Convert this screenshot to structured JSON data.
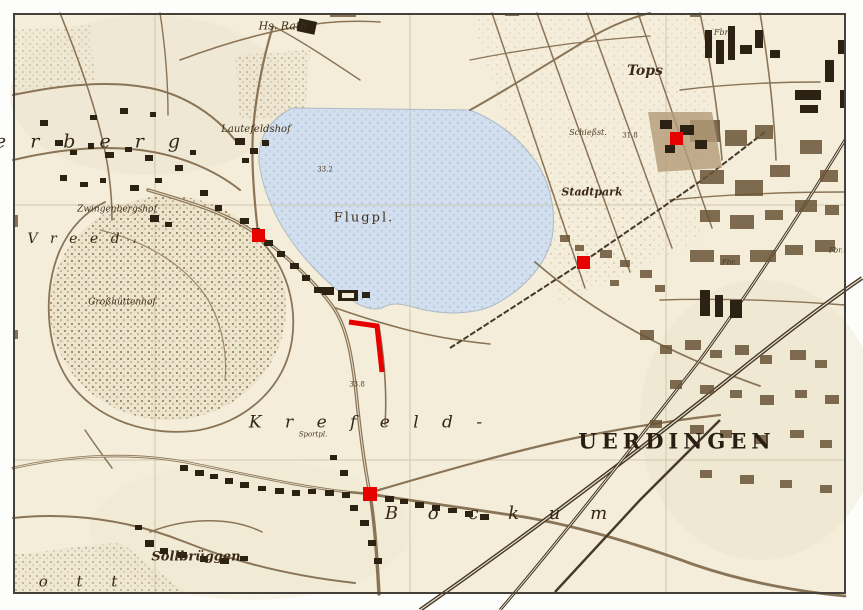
{
  "map": {
    "colors": {
      "paper": "#f3edda",
      "ink": "#3f2f1b",
      "building": "#2c2214",
      "road": "#8a7456",
      "rail": "#47392a",
      "water": "#d2dfee",
      "frame": "#45413a",
      "annotation_red": "#e60000"
    },
    "labels": [
      {
        "id": "hs-rath",
        "text": "Hs. Rath",
        "x": 283,
        "y": 26,
        "size": 11,
        "cls": "cursive"
      },
      {
        "id": "lautefeldshof",
        "text": "Lautefeldshof",
        "x": 256,
        "y": 130,
        "size": 10,
        "cls": "cursive"
      },
      {
        "id": "zwingenbergshof",
        "text": "Zwingenbergshof",
        "x": 117,
        "y": 210,
        "size": 9,
        "cls": "cursive"
      },
      {
        "id": "grosshuettenhof",
        "text": "Großhüttenhof",
        "x": 122,
        "y": 303,
        "size": 9,
        "cls": "cursive"
      },
      {
        "id": "flugplatz",
        "text": "Flugpl.",
        "x": 364,
        "y": 218,
        "size": 13,
        "cls": "serif-sp"
      },
      {
        "id": "height-33-2",
        "text": "33.2",
        "x": 325,
        "y": 170,
        "size": 7,
        "cls": "tiny"
      },
      {
        "id": "height-31-8",
        "text": "31.8",
        "x": 630,
        "y": 136,
        "size": 7,
        "cls": "tiny"
      },
      {
        "id": "height-33-8",
        "text": "33.8",
        "x": 357,
        "y": 385,
        "size": 7,
        "cls": "tiny"
      },
      {
        "id": "tops",
        "text": "Tops",
        "x": 645,
        "y": 71,
        "size": 14,
        "cls": "cursive-bold"
      },
      {
        "id": "stadtpark",
        "text": "Stadtpark",
        "x": 592,
        "y": 192,
        "size": 11,
        "cls": "cursive-bold"
      },
      {
        "id": "schiessstand",
        "text": "Schießst.",
        "x": 588,
        "y": 133,
        "size": 8,
        "cls": "tiny-italic"
      },
      {
        "id": "sollbrueggen",
        "text": "Sollbrüggen",
        "x": 196,
        "y": 557,
        "size": 13,
        "cls": "cursive-bold"
      },
      {
        "id": "sportplatz",
        "text": "Sportpl.",
        "x": 313,
        "y": 435,
        "size": 7,
        "cls": "tiny-italic"
      },
      {
        "id": "fabrik-1",
        "text": "Fbr.",
        "x": 722,
        "y": 33,
        "size": 8,
        "cls": "tiny-italic"
      },
      {
        "id": "fabrik-2",
        "text": "Fbr.",
        "x": 836,
        "y": 251,
        "size": 7,
        "cls": "tiny-italic"
      },
      {
        "id": "fabrik-3",
        "text": "Fbr.",
        "x": 729,
        "y": 263,
        "size": 7,
        "cls": "tiny-italic"
      },
      {
        "id": "verberg-letters",
        "text": "e r b e r g",
        "x": 92,
        "y": 142,
        "size": 19,
        "ls": 9,
        "cls": "spread-italic"
      },
      {
        "id": "vreed-letters",
        "text": "V r e e d .",
        "x": 84,
        "y": 239,
        "size": 14,
        "ls": 4,
        "cls": "spread-italic"
      },
      {
        "id": "krefeld-letters",
        "text": "K r e f e l d -",
        "x": 370,
        "y": 423,
        "size": 17,
        "ls": 9,
        "cls": "spread-italic"
      },
      {
        "id": "uerdingen",
        "text": "UERDINGEN",
        "x": 677,
        "y": 441,
        "size": 21,
        "ls": 5,
        "cls": "caps"
      },
      {
        "id": "bockum-letters",
        "text": "B o c k u m",
        "x": 502,
        "y": 514,
        "size": 18,
        "ls": 12,
        "cls": "spread-italic"
      },
      {
        "id": "ott-letters",
        "text": "o t t",
        "x": 84,
        "y": 582,
        "size": 15,
        "ls": 12,
        "cls": "spread-italic"
      }
    ],
    "annotations": {
      "color": "#e60000",
      "squares": [
        {
          "x": 258,
          "y": 235,
          "size": 13
        },
        {
          "x": 676,
          "y": 138,
          "size": 13
        },
        {
          "x": 583,
          "y": 262,
          "size": 13
        },
        {
          "x": 370,
          "y": 494,
          "size": 14
        }
      ],
      "line": {
        "points": "349,322 377,326 382,372",
        "width": 5
      }
    }
  }
}
